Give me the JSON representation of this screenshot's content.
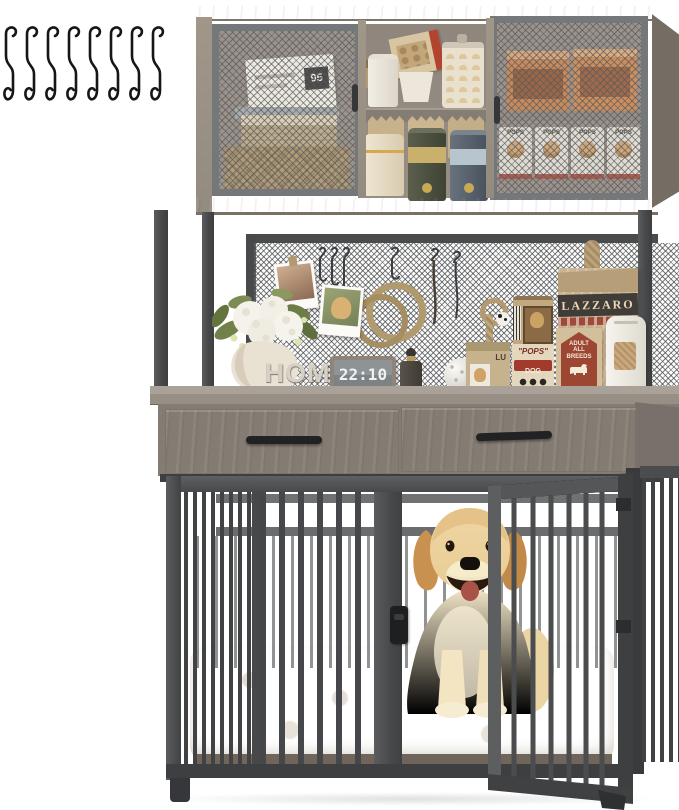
{
  "scene": {
    "subject": "Dog crate furniture with storage hutch, pegboard and golden retriever",
    "s_hook_count": 8
  },
  "hutch": {
    "left_cabinet": {
      "sign_text": "95"
    },
    "right_cabinet": {
      "bag_labels": [
        "POPS",
        "POPS",
        "POPS",
        "POPS"
      ]
    }
  },
  "decor": {
    "home_sign": "HOME",
    "clock_time": "22:10"
  },
  "supplies": {
    "lazzaro_brand": "LAZZARO",
    "breeds_badge": {
      "line1": "ADULT",
      "line2": "ALL",
      "line3": "BREEDS"
    },
    "pops_can": {
      "brand": "\"POPS\"",
      "type": "DOG FOOD"
    },
    "small_bag_text": "LU"
  },
  "colors": {
    "wood": "#9a9188",
    "wood_dark": "#7d756c",
    "metal_frame": "#46484a",
    "mesh_line": "#5a5c5e",
    "cushion": "#e9dfca",
    "dog_gold": "#d9a96c",
    "brand_red": "#9e4a38"
  }
}
